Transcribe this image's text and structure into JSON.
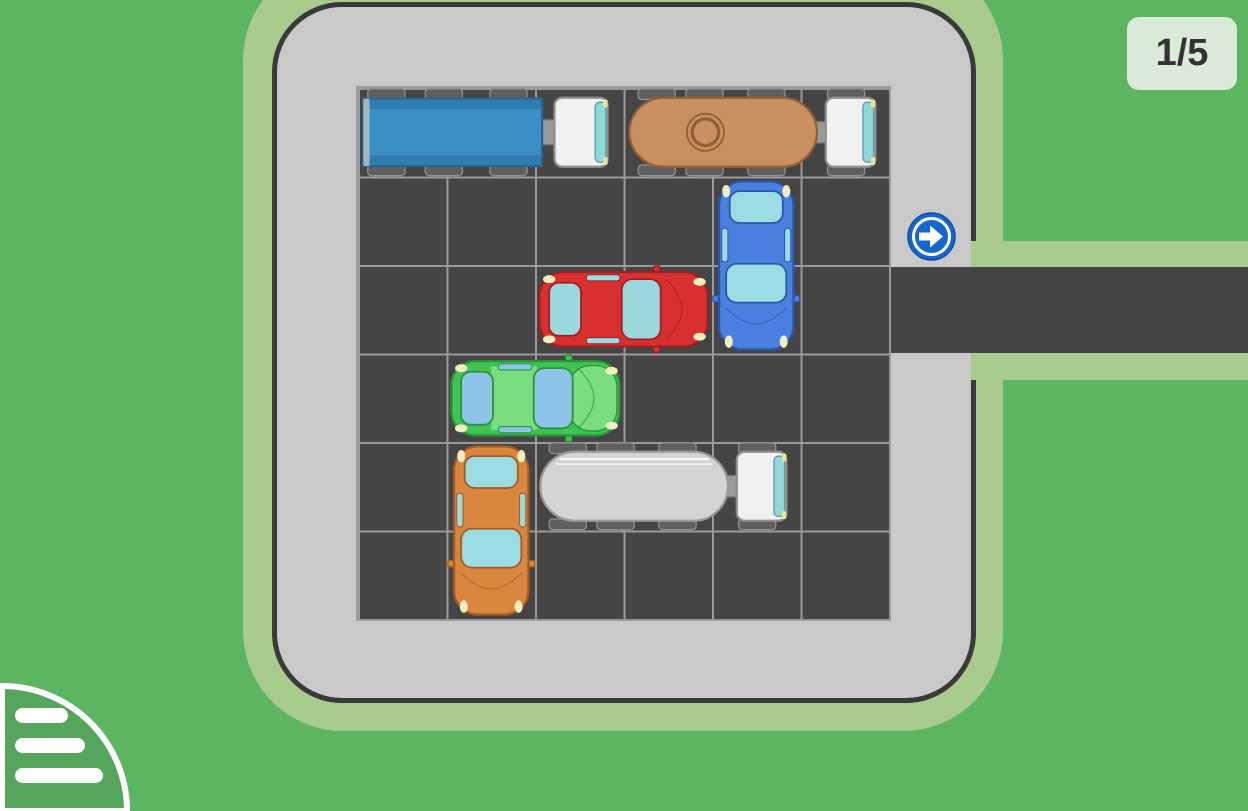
{
  "hud": {
    "level_badge": "1/5"
  },
  "board": {
    "rows": 6,
    "cols": 6,
    "cell_size": 88.5,
    "exit_row": 2,
    "exit_side": "right"
  },
  "icons": {
    "exit_sign": "arrow-right-circle-icon",
    "menu": "hamburger-menu-icon"
  },
  "colors": {
    "background": "#5cb560",
    "lot_border_band": "#a9cb8d",
    "lot_surface": "#c9c9c9",
    "lot_outline": "#3a3a3a",
    "grid_surface": "#454545",
    "grid_line": "#9b9b9b",
    "road": "#454545",
    "sign_blue": "#1467d2",
    "badge_bg": "#dbead8",
    "badge_text": "#333333",
    "menu_fill": "#55a55c"
  },
  "vehicles": [
    {
      "id": "blue-truck",
      "label": "blue cargo truck",
      "kind": "cargo-truck",
      "row": 0,
      "col": 0,
      "length": 3,
      "orientation": "horizontal",
      "facing": "right",
      "body": "#3a8fc4",
      "trim": "#2e7cb0",
      "outline": "#27648f",
      "window": "#8ed8da"
    },
    {
      "id": "tan-tanker-truck",
      "label": "tan tanker truck",
      "kind": "tanker-truck",
      "row": 0,
      "col": 3,
      "length": 3,
      "orientation": "horizontal",
      "facing": "right",
      "body": "#c9905f",
      "outline": "#8d5f36",
      "window": "#8ed8da",
      "manhole": true
    },
    {
      "id": "blue-car",
      "label": "blue car",
      "kind": "car",
      "row": 1,
      "col": 4,
      "length": 2,
      "orientation": "vertical",
      "facing": "down",
      "body": "#4a80e0",
      "outline": "#2d55a8",
      "window": "#9bdce2"
    },
    {
      "id": "red-car",
      "label": "red car",
      "kind": "car",
      "row": 2,
      "col": 2,
      "length": 2,
      "orientation": "horizontal",
      "facing": "right",
      "body": "#d83030",
      "outline": "#9e1f22",
      "window": "#9bd8de"
    },
    {
      "id": "green-car",
      "label": "green car",
      "kind": "car",
      "row": 3,
      "col": 1,
      "length": 2,
      "orientation": "horizontal",
      "facing": "right",
      "body": "#3ec452",
      "accent": "#79dd82",
      "outline": "#2b9038",
      "window": "#8cc5e8"
    },
    {
      "id": "orange-car",
      "label": "orange car",
      "kind": "car",
      "row": 4,
      "col": 1,
      "length": 2,
      "orientation": "vertical",
      "facing": "down",
      "body": "#d9873f",
      "outline": "#a05c22",
      "window": "#9bdce2"
    },
    {
      "id": "white-tanker-truck",
      "label": "white tanker truck",
      "kind": "tanker-truck",
      "row": 4,
      "col": 2,
      "length": 3,
      "orientation": "horizontal",
      "facing": "right",
      "body": "#d4d4d4",
      "outline": "#9a9a9a",
      "window": "#8ed8da",
      "stripe": true
    }
  ]
}
